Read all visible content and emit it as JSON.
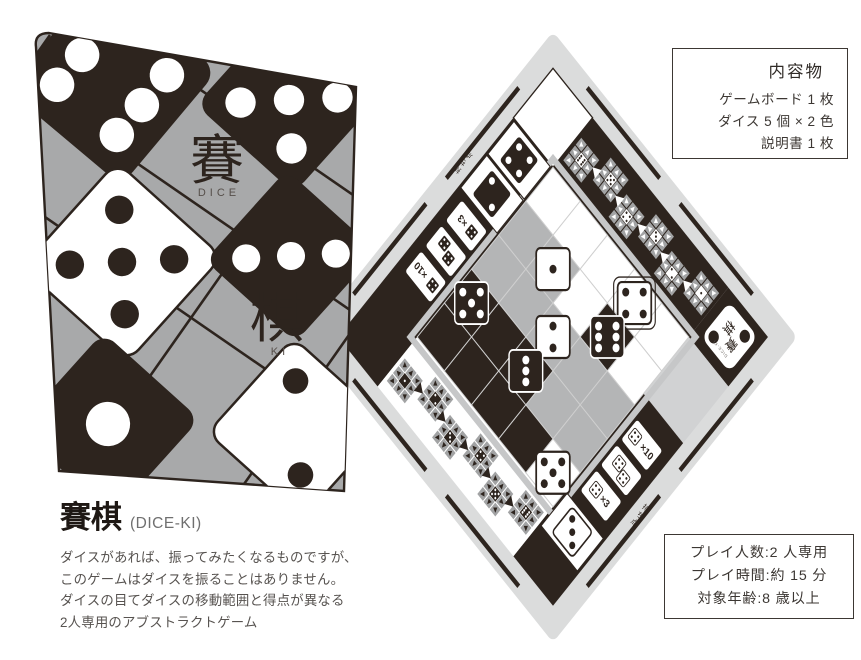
{
  "title_block": {
    "title": "賽棋",
    "subtitle": "(DICE-KI)",
    "description_lines": [
      "ダイスがあれば、振ってみたくなるものですが、",
      "このゲームはダイスを振ることはありません。",
      "ダイスの目てダイスの移動範囲と得点が異なる",
      "2人専用のアブストラクトゲーム"
    ]
  },
  "contents_box": {
    "title": "内容物",
    "items": [
      "ゲームボード 1 枚",
      "ダイス 5 個 × 2 色",
      "説明書 1 枚"
    ]
  },
  "spec_box": {
    "lines": [
      "プレイ人数:2 人専用",
      "プレイ時間:約 15 分",
      "対象年齢:8 歳以上"
    ]
  },
  "box_cover": {
    "kanji_top": "賽",
    "kanji_top_sub": "DICE",
    "kanji_bottom": "棋",
    "kanji_bottom_sub": "KI",
    "dice": [
      {
        "x": 112,
        "y": 80,
        "size": 150,
        "color": "black",
        "value": 6,
        "rot": 40
      },
      {
        "x": 289,
        "y": 100,
        "size": 132,
        "color": "black",
        "value": 5,
        "rot": 42
      },
      {
        "x": 122,
        "y": 262,
        "size": 142,
        "color": "white",
        "value": 5,
        "rot": 42
      },
      {
        "x": 291,
        "y": 256,
        "size": 122,
        "color": "black",
        "value": 3,
        "rot": 42,
        "pip_layout": "row"
      },
      {
        "x": 108,
        "y": 424,
        "size": 130,
        "color": "black",
        "value": 1,
        "rot": 42
      },
      {
        "x": 298,
        "y": 428,
        "size": 128,
        "color": "white",
        "value": 2,
        "rot": 42
      }
    ]
  },
  "board": {
    "score_label": "持ち点",
    "logo": {
      "kanji_1": "賽",
      "kanji_2": "棋",
      "sub_1": "DICE",
      "sub_2": "KI"
    },
    "token_labels": {
      "tens": "×10",
      "triple": "×3"
    },
    "guide_values_top": [
      6,
      5,
      4,
      3,
      2,
      1
    ],
    "guide_values_bottom": [
      1,
      2,
      3,
      4,
      5,
      6
    ],
    "grid": {
      "rows": 5,
      "cols": 5,
      "cell_colors": [
        [
          "W",
          "W",
          "W",
          "W",
          "W"
        ],
        [
          "G",
          "G",
          "W",
          "D",
          "W"
        ],
        [
          "G",
          "G",
          "G",
          "G",
          "G"
        ],
        [
          "D",
          "D",
          "D",
          "G",
          "G"
        ],
        [
          "D",
          "D",
          "D",
          "D",
          "W"
        ]
      ]
    },
    "dice_on_grid": [
      {
        "row": 1,
        "col": 4,
        "color": "white",
        "value": 4,
        "highlight": true
      },
      {
        "row": 2,
        "col": 2,
        "color": "white",
        "value": 1
      },
      {
        "row": 2,
        "col": 4,
        "color": "black",
        "value": 6
      },
      {
        "row": 3,
        "col": 3,
        "color": "white",
        "value": 2
      },
      {
        "row": 4,
        "col": 1,
        "color": "black",
        "value": 5
      },
      {
        "row": 4,
        "col": 3,
        "color": "black",
        "value": 3
      },
      {
        "row": 5,
        "col": 5,
        "color": "white",
        "value": 5
      }
    ],
    "held_dice": {
      "black": [
        4,
        2
      ],
      "white": [
        3
      ]
    }
  },
  "colors": {
    "ink": "#2d241e",
    "board_gray": "#b4b5b6",
    "board_ring": "#dbdcdc",
    "board_light": "#d1d2d3",
    "arrow_cell": "#a2a3a4",
    "box_gray": "#a8a9aa"
  }
}
